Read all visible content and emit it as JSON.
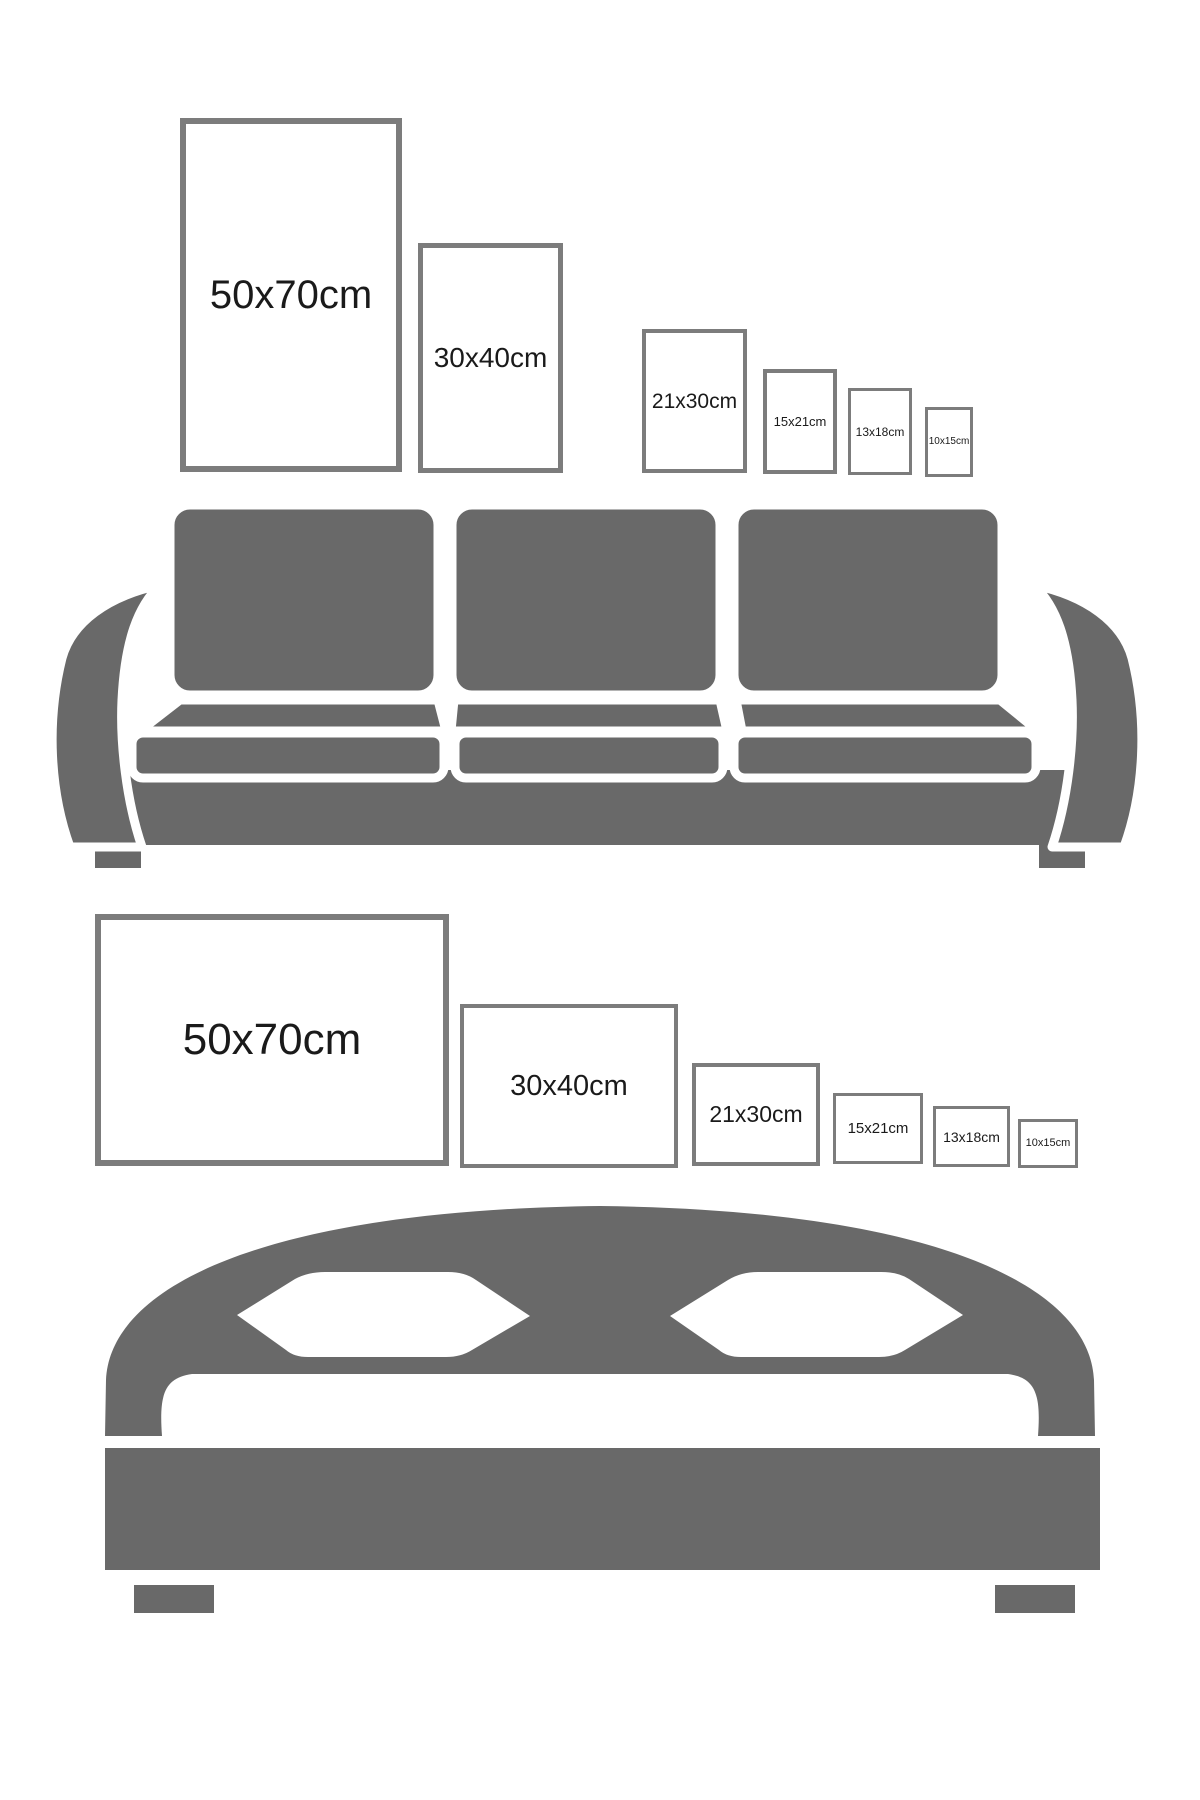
{
  "title": "Wall art print size comparison guide",
  "colors": {
    "background": "#ffffff",
    "furniture_gray": "#696969",
    "frame_border": "#7c7c7c",
    "label_text": "#1a1a1a"
  },
  "sofa_section": {
    "illustration": "sofa",
    "orientation": "portrait",
    "frames": [
      {
        "label": "50x70cm"
      },
      {
        "label": "30x40cm"
      },
      {
        "label": "21x30cm"
      },
      {
        "label": "15x21cm"
      },
      {
        "label": "13x18cm"
      },
      {
        "label": "10x15cm"
      }
    ]
  },
  "bed_section": {
    "illustration": "bed",
    "orientation": "landscape",
    "frames": [
      {
        "label": "50x70cm"
      },
      {
        "label": "30x40cm"
      },
      {
        "label": "21x30cm"
      },
      {
        "label": "15x21cm"
      },
      {
        "label": "13x18cm"
      },
      {
        "label": "10x15cm"
      }
    ]
  }
}
